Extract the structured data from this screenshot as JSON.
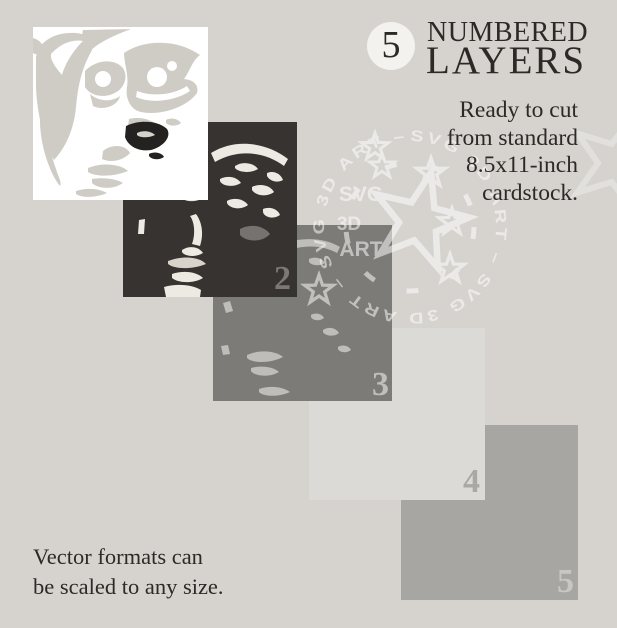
{
  "header": {
    "badge_number": "5",
    "title_line1": "NUMBERED",
    "title_line2": "LAYERS"
  },
  "tagline": {
    "line1": "Ready to cut",
    "line2": "from standard",
    "line3": "8.5x11-inch",
    "line4": "cardstock."
  },
  "footer_note": {
    "line1": "Vector formats can",
    "line2": "be scaled to any size."
  },
  "layers": {
    "items": [
      {
        "name": "layer-1",
        "number": "",
        "color": "#ffffff"
      },
      {
        "name": "layer-2",
        "number": "2",
        "color": "#363330"
      },
      {
        "name": "layer-3",
        "number": "3",
        "color": "#7d7b78"
      },
      {
        "name": "layer-4",
        "number": "4",
        "color": "#dcdad7"
      },
      {
        "name": "layer-5",
        "number": "5",
        "color": "#a8a6a3"
      }
    ]
  },
  "watermark": {
    "ring_text": "SVG 3D ART – SVG 3D ART – SVG 3D ART –",
    "stack_line1": "SVG",
    "stack_line2": "3D",
    "stack_line3": "ART"
  },
  "colors": {
    "background": "#d6d3cf",
    "text": "#2c2926",
    "badge_bg": "#f4f2ef",
    "watermark": "#ffffff"
  }
}
